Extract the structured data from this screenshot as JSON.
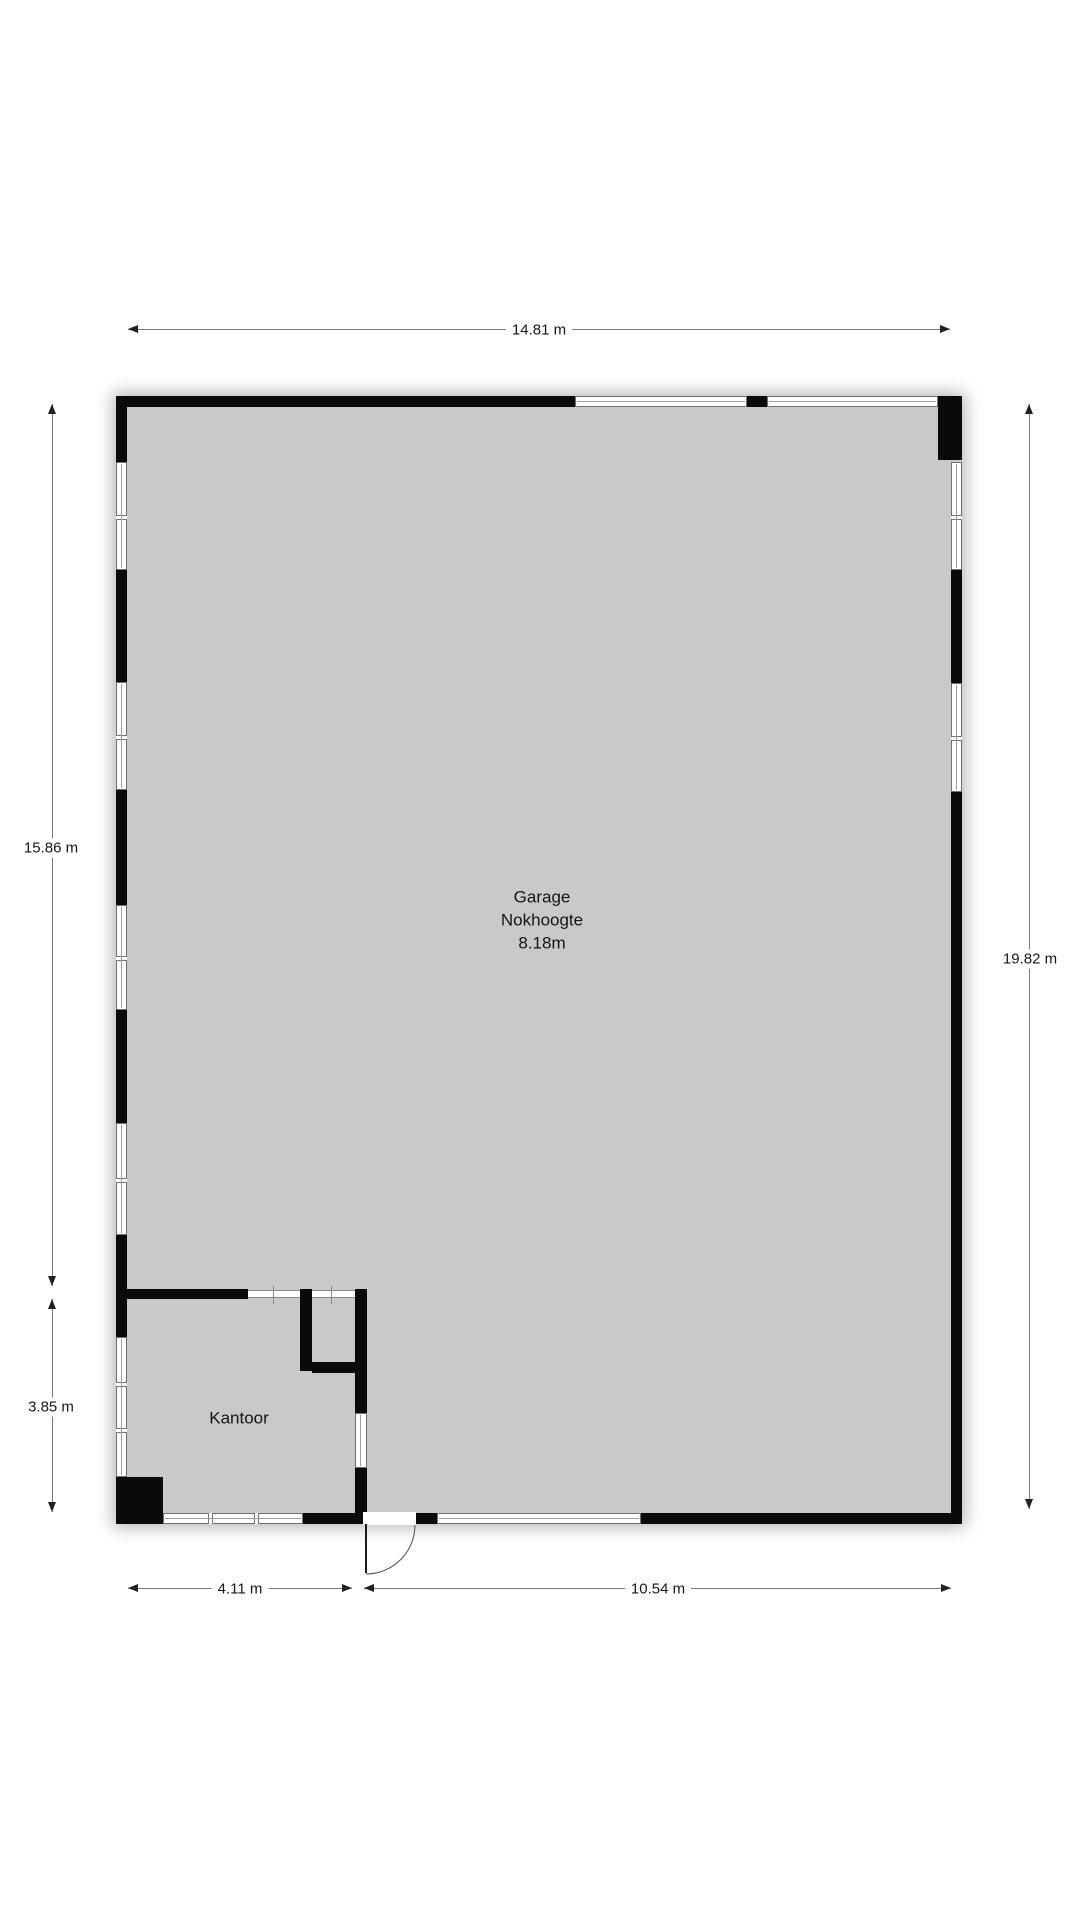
{
  "plan": {
    "type": "floor-plan",
    "colors": {
      "floor": "#c9c9ca",
      "wall": "#0a0a0a",
      "window_frame": "#6f6f6f",
      "dimension_line": "#7c7c7c",
      "text": "#161616",
      "background": "#ffffff"
    }
  },
  "rooms": {
    "garage": {
      "name": "Garage",
      "line2": "Nokhoogte",
      "line3": "8.18m"
    },
    "kantoor": {
      "name": "Kantoor"
    }
  },
  "dimensions": {
    "top": "14.81 m",
    "left_upper": "15.86 m",
    "left_lower": "3.85 m",
    "right": "19.82 m",
    "bottom_left": "4.11 m",
    "bottom_right": "10.54 m"
  }
}
